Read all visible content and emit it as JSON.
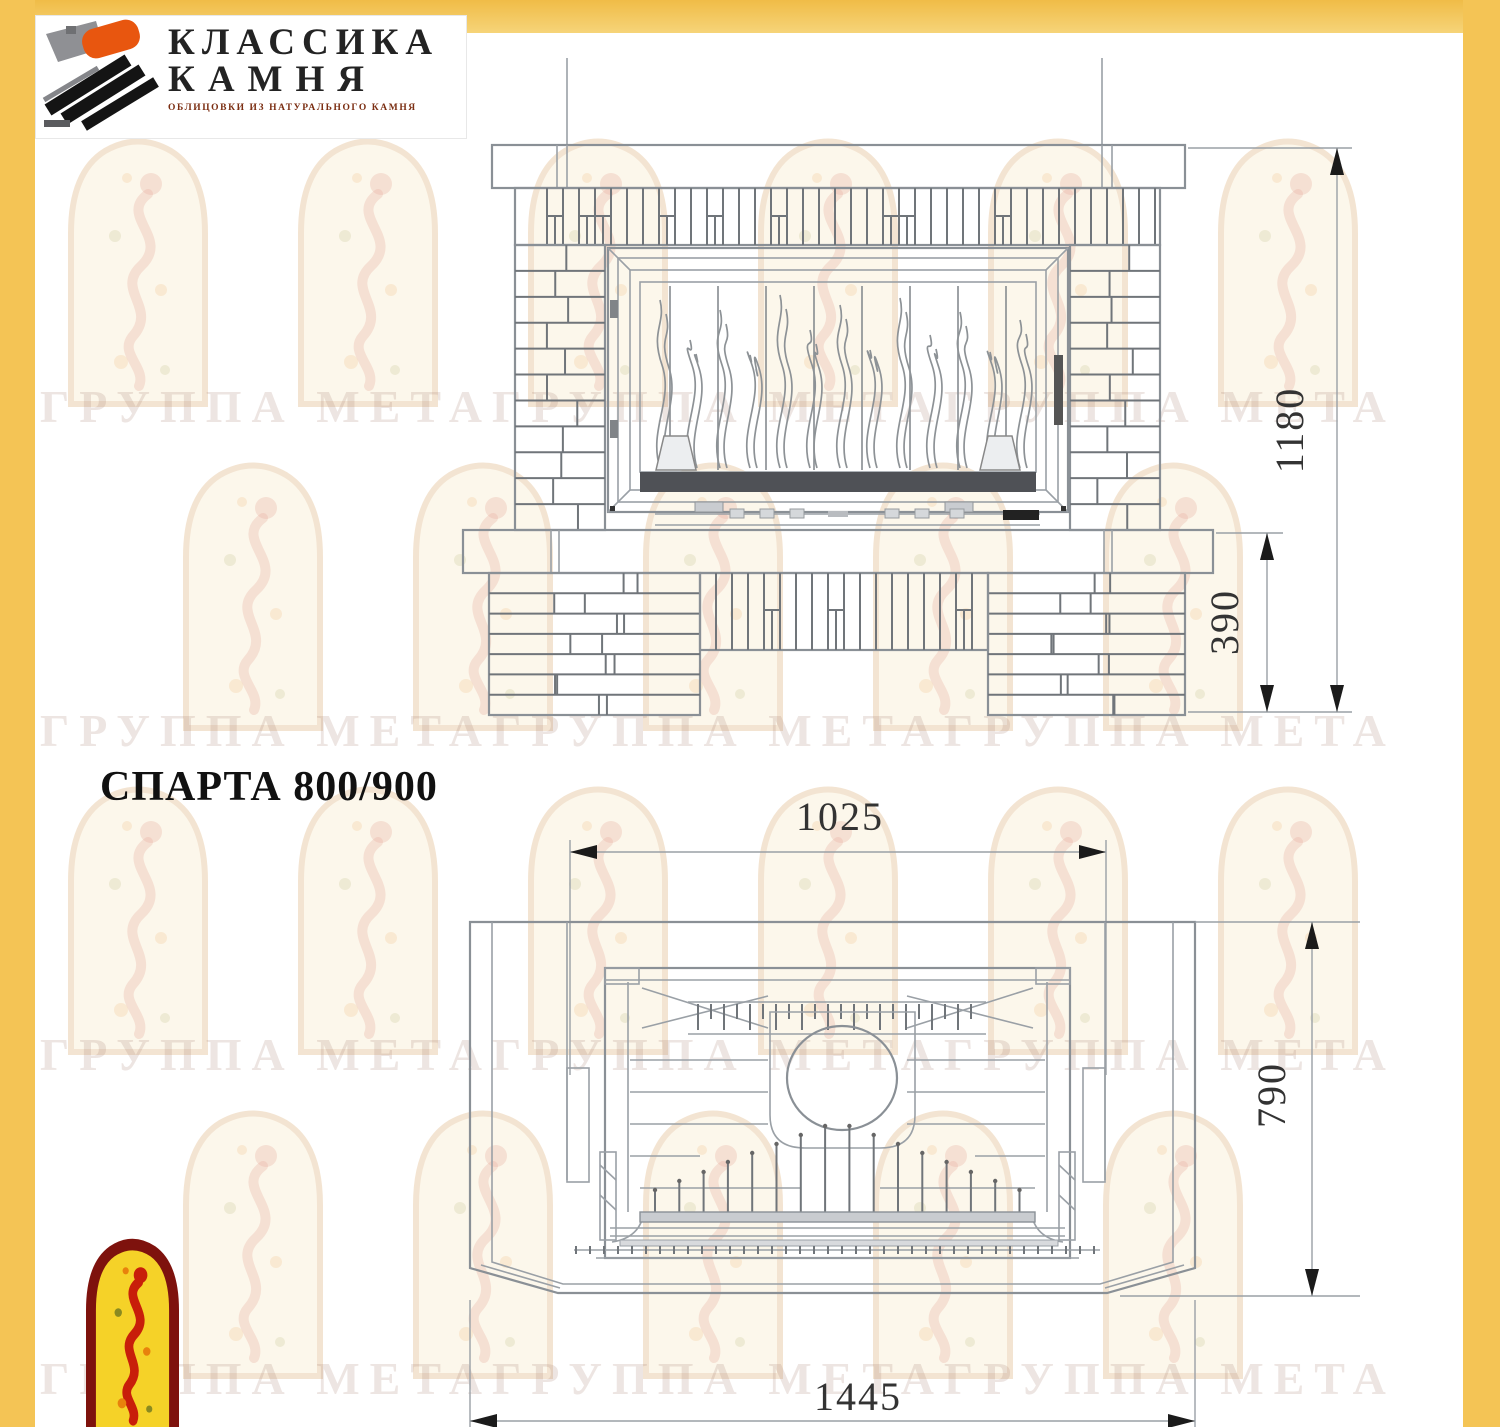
{
  "page": {
    "frame_color": "#f4c455",
    "paper_color": "#ffffff"
  },
  "logo": {
    "title_line1": "КЛАССИКА",
    "title_line2": "КАМНЯ",
    "subtitle": "ОБЛИЦОВКИ ИЗ НАТУРАЛЬНОГО КАМНЯ",
    "accent_orange": "#e8560f",
    "accent_black": "#141414",
    "accent_gray": "#8f9094"
  },
  "watermark": {
    "row_text": "ГРУППА МЕТАГРУППА МЕТАГРУППА МЕТА",
    "arch_fill": "#faf0d8",
    "arch_border": "#e9cba6"
  },
  "corner_logo": {
    "arch_fill": "#f5d228",
    "arch_border": "#7e120d",
    "figure_color": "#c81e0a"
  },
  "drawing": {
    "title": "СПАРТА 800/900",
    "front_view": {
      "total_height_label": "1180",
      "base_height_label": "390"
    },
    "plan_view": {
      "top_width_label": "1025",
      "depth_label": "790",
      "total_width_label": "1445"
    }
  }
}
